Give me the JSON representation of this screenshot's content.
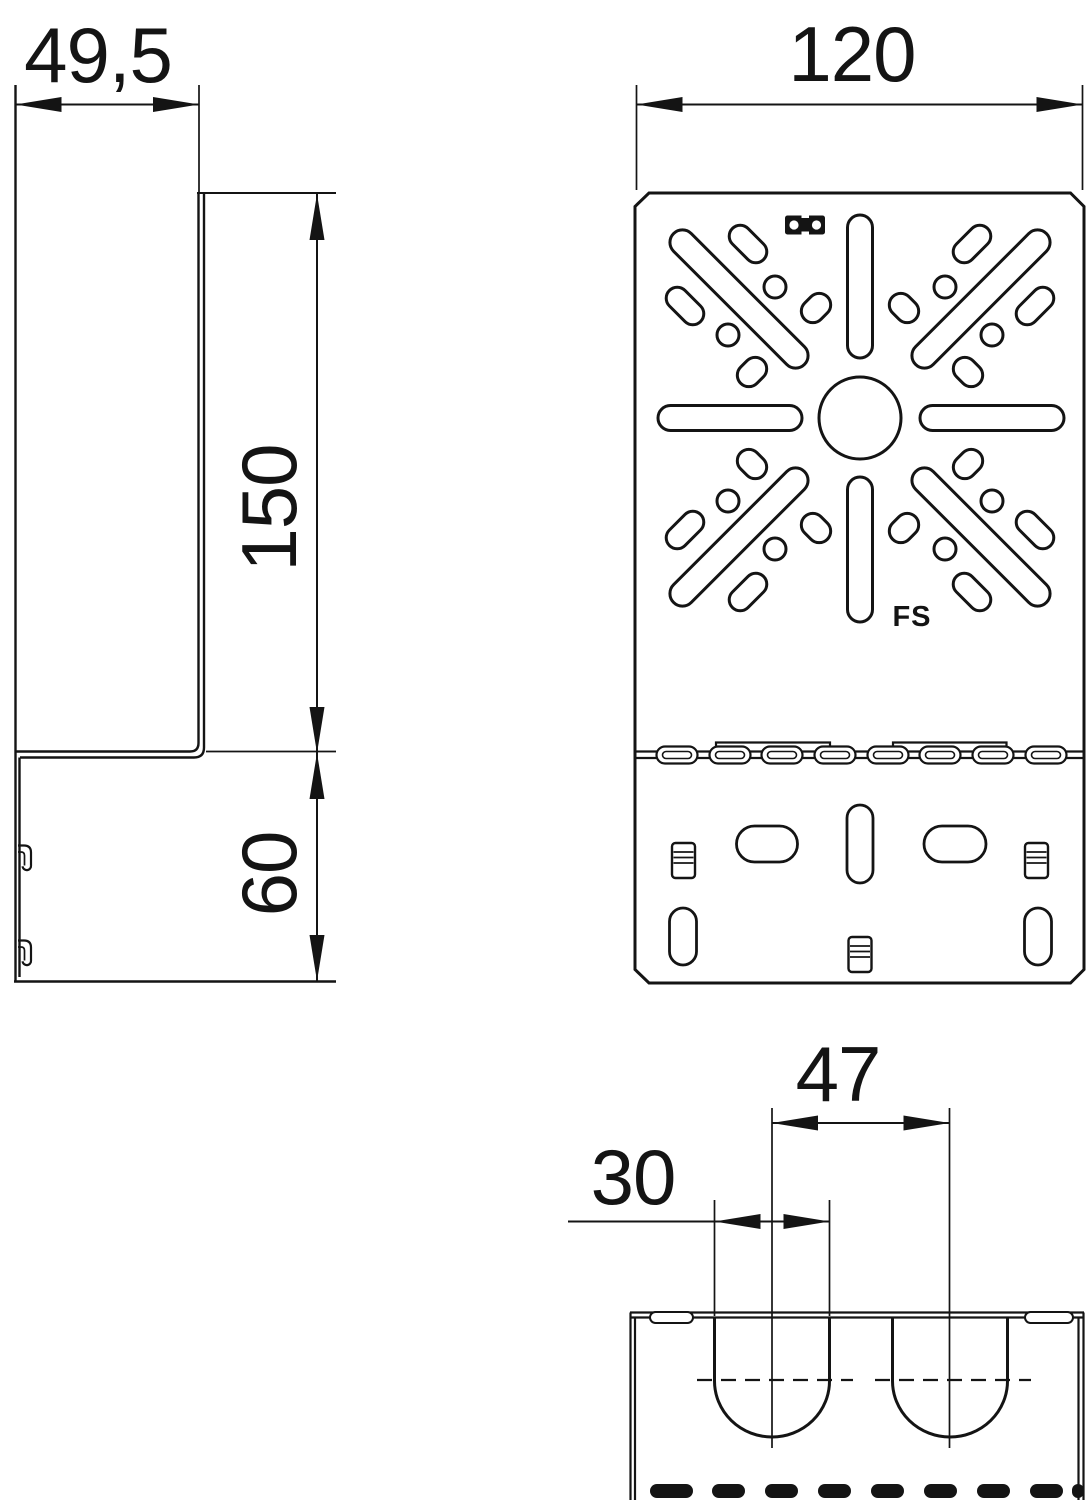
{
  "colors": {
    "line": "#141414",
    "background": "#ffffff"
  },
  "views": {
    "side": {
      "dim_depth": "49,5",
      "dim_plate_height": "150",
      "dim_channel_height": "60"
    },
    "front": {
      "dim_width": "120",
      "surface_marking": "FS"
    },
    "detail": {
      "dim_slot_spacing": "47",
      "dim_slot_width": "30"
    }
  }
}
